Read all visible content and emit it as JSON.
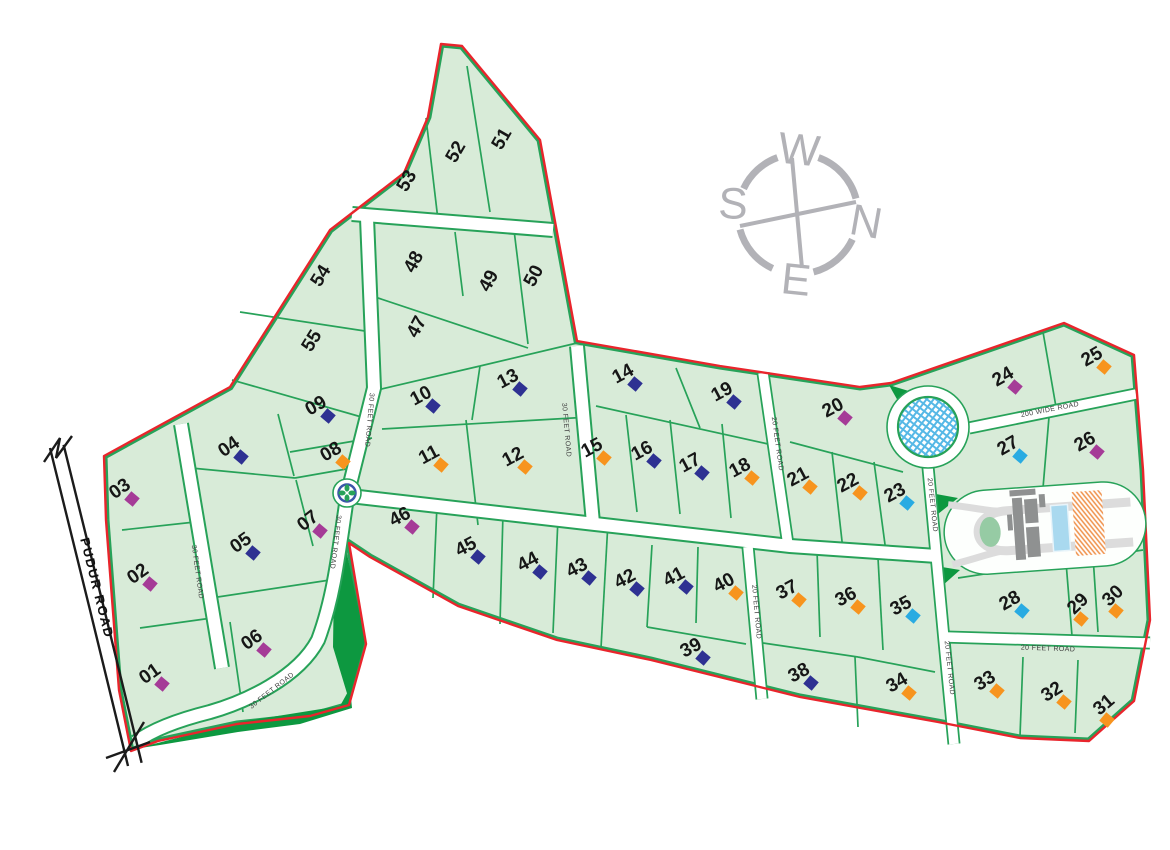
{
  "compass": {
    "top": "W",
    "right": "N",
    "bottom": "E",
    "left": "S"
  },
  "roads": {
    "pudur": {
      "label": "PUDUR ROAD",
      "x": 97,
      "y": 588,
      "rot": 76
    },
    "labels": [
      {
        "text": "30 FEET ROAD",
        "x": 197,
        "y": 572,
        "rot": 82
      },
      {
        "text": "30 FEET ROAD",
        "x": 369,
        "y": 420,
        "rot": 95
      },
      {
        "text": "30 FEET ROAD",
        "x": 335,
        "y": 542,
        "rot": 97
      },
      {
        "text": "30 FEET ROAD",
        "x": 272,
        "y": 691,
        "rot": -38
      },
      {
        "text": "30 FEET ROAD",
        "x": 566,
        "y": 430,
        "rot": 85
      },
      {
        "text": "20 FEET ROAD",
        "x": 777,
        "y": 444,
        "rot": 82
      },
      {
        "text": "200 WIDE ROAD",
        "x": 1050,
        "y": 410,
        "rot": -11
      },
      {
        "text": "20 FEET ROAD",
        "x": 932,
        "y": 505,
        "rot": 84
      },
      {
        "text": "20 FEET ROAD",
        "x": 949,
        "y": 668,
        "rot": 84
      },
      {
        "text": "20 FEET ROAD",
        "x": 1048,
        "y": 649,
        "rot": 2
      },
      {
        "text": "20 FEET ROAD",
        "x": 756,
        "y": 612,
        "rot": 85
      }
    ]
  },
  "plots": [
    {
      "label": "01",
      "x": 150,
      "y": 674,
      "rot": -35,
      "marker": "purple"
    },
    {
      "label": "02",
      "x": 138,
      "y": 574,
      "rot": -35,
      "marker": "purple"
    },
    {
      "label": "03",
      "x": 120,
      "y": 489,
      "rot": -35,
      "marker": "purple"
    },
    {
      "label": "04",
      "x": 229,
      "y": 447,
      "rot": -35,
      "marker": "navy"
    },
    {
      "label": "05",
      "x": 241,
      "y": 543,
      "rot": -35,
      "marker": "navy"
    },
    {
      "label": "06",
      "x": 252,
      "y": 640,
      "rot": -35,
      "marker": "purple"
    },
    {
      "label": "07",
      "x": 308,
      "y": 521,
      "rot": -38,
      "marker": "purple"
    },
    {
      "label": "08",
      "x": 331,
      "y": 452,
      "rot": -30,
      "marker": "orange"
    },
    {
      "label": "09",
      "x": 316,
      "y": 406,
      "rot": -30,
      "marker": "navy"
    },
    {
      "label": "10",
      "x": 421,
      "y": 396,
      "rot": -28,
      "marker": "navy"
    },
    {
      "label": "11",
      "x": 429,
      "y": 455,
      "rot": -28,
      "marker": "orange"
    },
    {
      "label": "12",
      "x": 513,
      "y": 457,
      "rot": -28,
      "marker": "orange"
    },
    {
      "label": "13",
      "x": 508,
      "y": 379,
      "rot": -28,
      "marker": "navy"
    },
    {
      "label": "14",
      "x": 623,
      "y": 374,
      "rot": -28,
      "marker": "navy"
    },
    {
      "label": "15",
      "x": 592,
      "y": 448,
      "rot": -28,
      "marker": "orange"
    },
    {
      "label": "16",
      "x": 642,
      "y": 451,
      "rot": -28,
      "marker": "navy"
    },
    {
      "label": "17",
      "x": 690,
      "y": 463,
      "rot": -28,
      "marker": "navy"
    },
    {
      "label": "18",
      "x": 740,
      "y": 468,
      "rot": -28,
      "marker": "orange"
    },
    {
      "label": "19",
      "x": 722,
      "y": 392,
      "rot": -28,
      "marker": "navy"
    },
    {
      "label": "20",
      "x": 833,
      "y": 408,
      "rot": -28,
      "marker": "purple"
    },
    {
      "label": "21",
      "x": 798,
      "y": 477,
      "rot": -28,
      "marker": "orange"
    },
    {
      "label": "22",
      "x": 848,
      "y": 483,
      "rot": -28,
      "marker": "orange"
    },
    {
      "label": "23",
      "x": 895,
      "y": 493,
      "rot": -28,
      "marker": "cyan"
    },
    {
      "label": "24",
      "x": 1003,
      "y": 377,
      "rot": -30,
      "marker": "purple"
    },
    {
      "label": "25",
      "x": 1092,
      "y": 357,
      "rot": -30,
      "marker": "orange"
    },
    {
      "label": "26",
      "x": 1085,
      "y": 442,
      "rot": -30,
      "marker": "purple"
    },
    {
      "label": "27",
      "x": 1008,
      "y": 446,
      "rot": -30,
      "marker": "cyan"
    },
    {
      "label": "28",
      "x": 1010,
      "y": 601,
      "rot": -30,
      "marker": "cyan"
    },
    {
      "label": "29",
      "x": 1078,
      "y": 604,
      "rot": -44,
      "marker": "orange"
    },
    {
      "label": "30",
      "x": 1113,
      "y": 596,
      "rot": -44,
      "marker": "orange"
    },
    {
      "label": "31",
      "x": 1104,
      "y": 705,
      "rot": -40,
      "marker": "orange"
    },
    {
      "label": "32",
      "x": 1052,
      "y": 692,
      "rot": -32,
      "marker": "orange"
    },
    {
      "label": "33",
      "x": 985,
      "y": 681,
      "rot": -32,
      "marker": "orange"
    },
    {
      "label": "34",
      "x": 897,
      "y": 683,
      "rot": -30,
      "marker": "orange"
    },
    {
      "label": "35",
      "x": 901,
      "y": 606,
      "rot": -28,
      "marker": "cyan"
    },
    {
      "label": "36",
      "x": 846,
      "y": 597,
      "rot": -28,
      "marker": "orange"
    },
    {
      "label": "37",
      "x": 787,
      "y": 590,
      "rot": -28,
      "marker": "orange"
    },
    {
      "label": "38",
      "x": 799,
      "y": 673,
      "rot": -28,
      "marker": "navy"
    },
    {
      "label": "39",
      "x": 691,
      "y": 648,
      "rot": -28,
      "marker": "navy"
    },
    {
      "label": "40",
      "x": 724,
      "y": 583,
      "rot": -28,
      "marker": "orange"
    },
    {
      "label": "41",
      "x": 674,
      "y": 577,
      "rot": -28,
      "marker": "navy"
    },
    {
      "label": "42",
      "x": 625,
      "y": 579,
      "rot": -28,
      "marker": "navy"
    },
    {
      "label": "43",
      "x": 577,
      "y": 568,
      "rot": -28,
      "marker": "navy"
    },
    {
      "label": "44",
      "x": 528,
      "y": 562,
      "rot": -28,
      "marker": "navy"
    },
    {
      "label": "45",
      "x": 466,
      "y": 547,
      "rot": -28,
      "marker": "navy"
    },
    {
      "label": "46",
      "x": 400,
      "y": 517,
      "rot": -28,
      "marker": "purple"
    },
    {
      "label": "47",
      "x": 417,
      "y": 327,
      "rot": -62,
      "marker": null
    },
    {
      "label": "48",
      "x": 414,
      "y": 262,
      "rot": -62,
      "marker": null
    },
    {
      "label": "49",
      "x": 489,
      "y": 281,
      "rot": -62,
      "marker": null
    },
    {
      "label": "50",
      "x": 534,
      "y": 276,
      "rot": -62,
      "marker": null
    },
    {
      "label": "51",
      "x": 502,
      "y": 139,
      "rot": -60,
      "marker": null
    },
    {
      "label": "52",
      "x": 456,
      "y": 152,
      "rot": -60,
      "marker": null
    },
    {
      "label": "53",
      "x": 407,
      "y": 181,
      "rot": -60,
      "marker": null
    },
    {
      "label": "54",
      "x": 321,
      "y": 276,
      "rot": -58,
      "marker": null
    },
    {
      "label": "55",
      "x": 312,
      "y": 341,
      "rot": -58,
      "marker": null
    }
  ],
  "colors": {
    "plot_fill": "#d8ebd8",
    "plot_line": "#27a259",
    "boundary_red": "#e9252c",
    "dark_green": "#0d9840",
    "marker_navy": "#2e3192",
    "marker_orange": "#f7941e",
    "marker_purple": "#a53b97",
    "marker_cyan": "#29abe2",
    "compass_gray": "#b2b2b7",
    "pool_blue": "#a9d9ef",
    "hatch_orange": "#ef9048",
    "pattern_blue": "#56b8e6",
    "road_white": "#ffffff",
    "pudur_black": "#1b1b1b",
    "label_dark": "#3f3f3f",
    "number_black": "#161616"
  }
}
